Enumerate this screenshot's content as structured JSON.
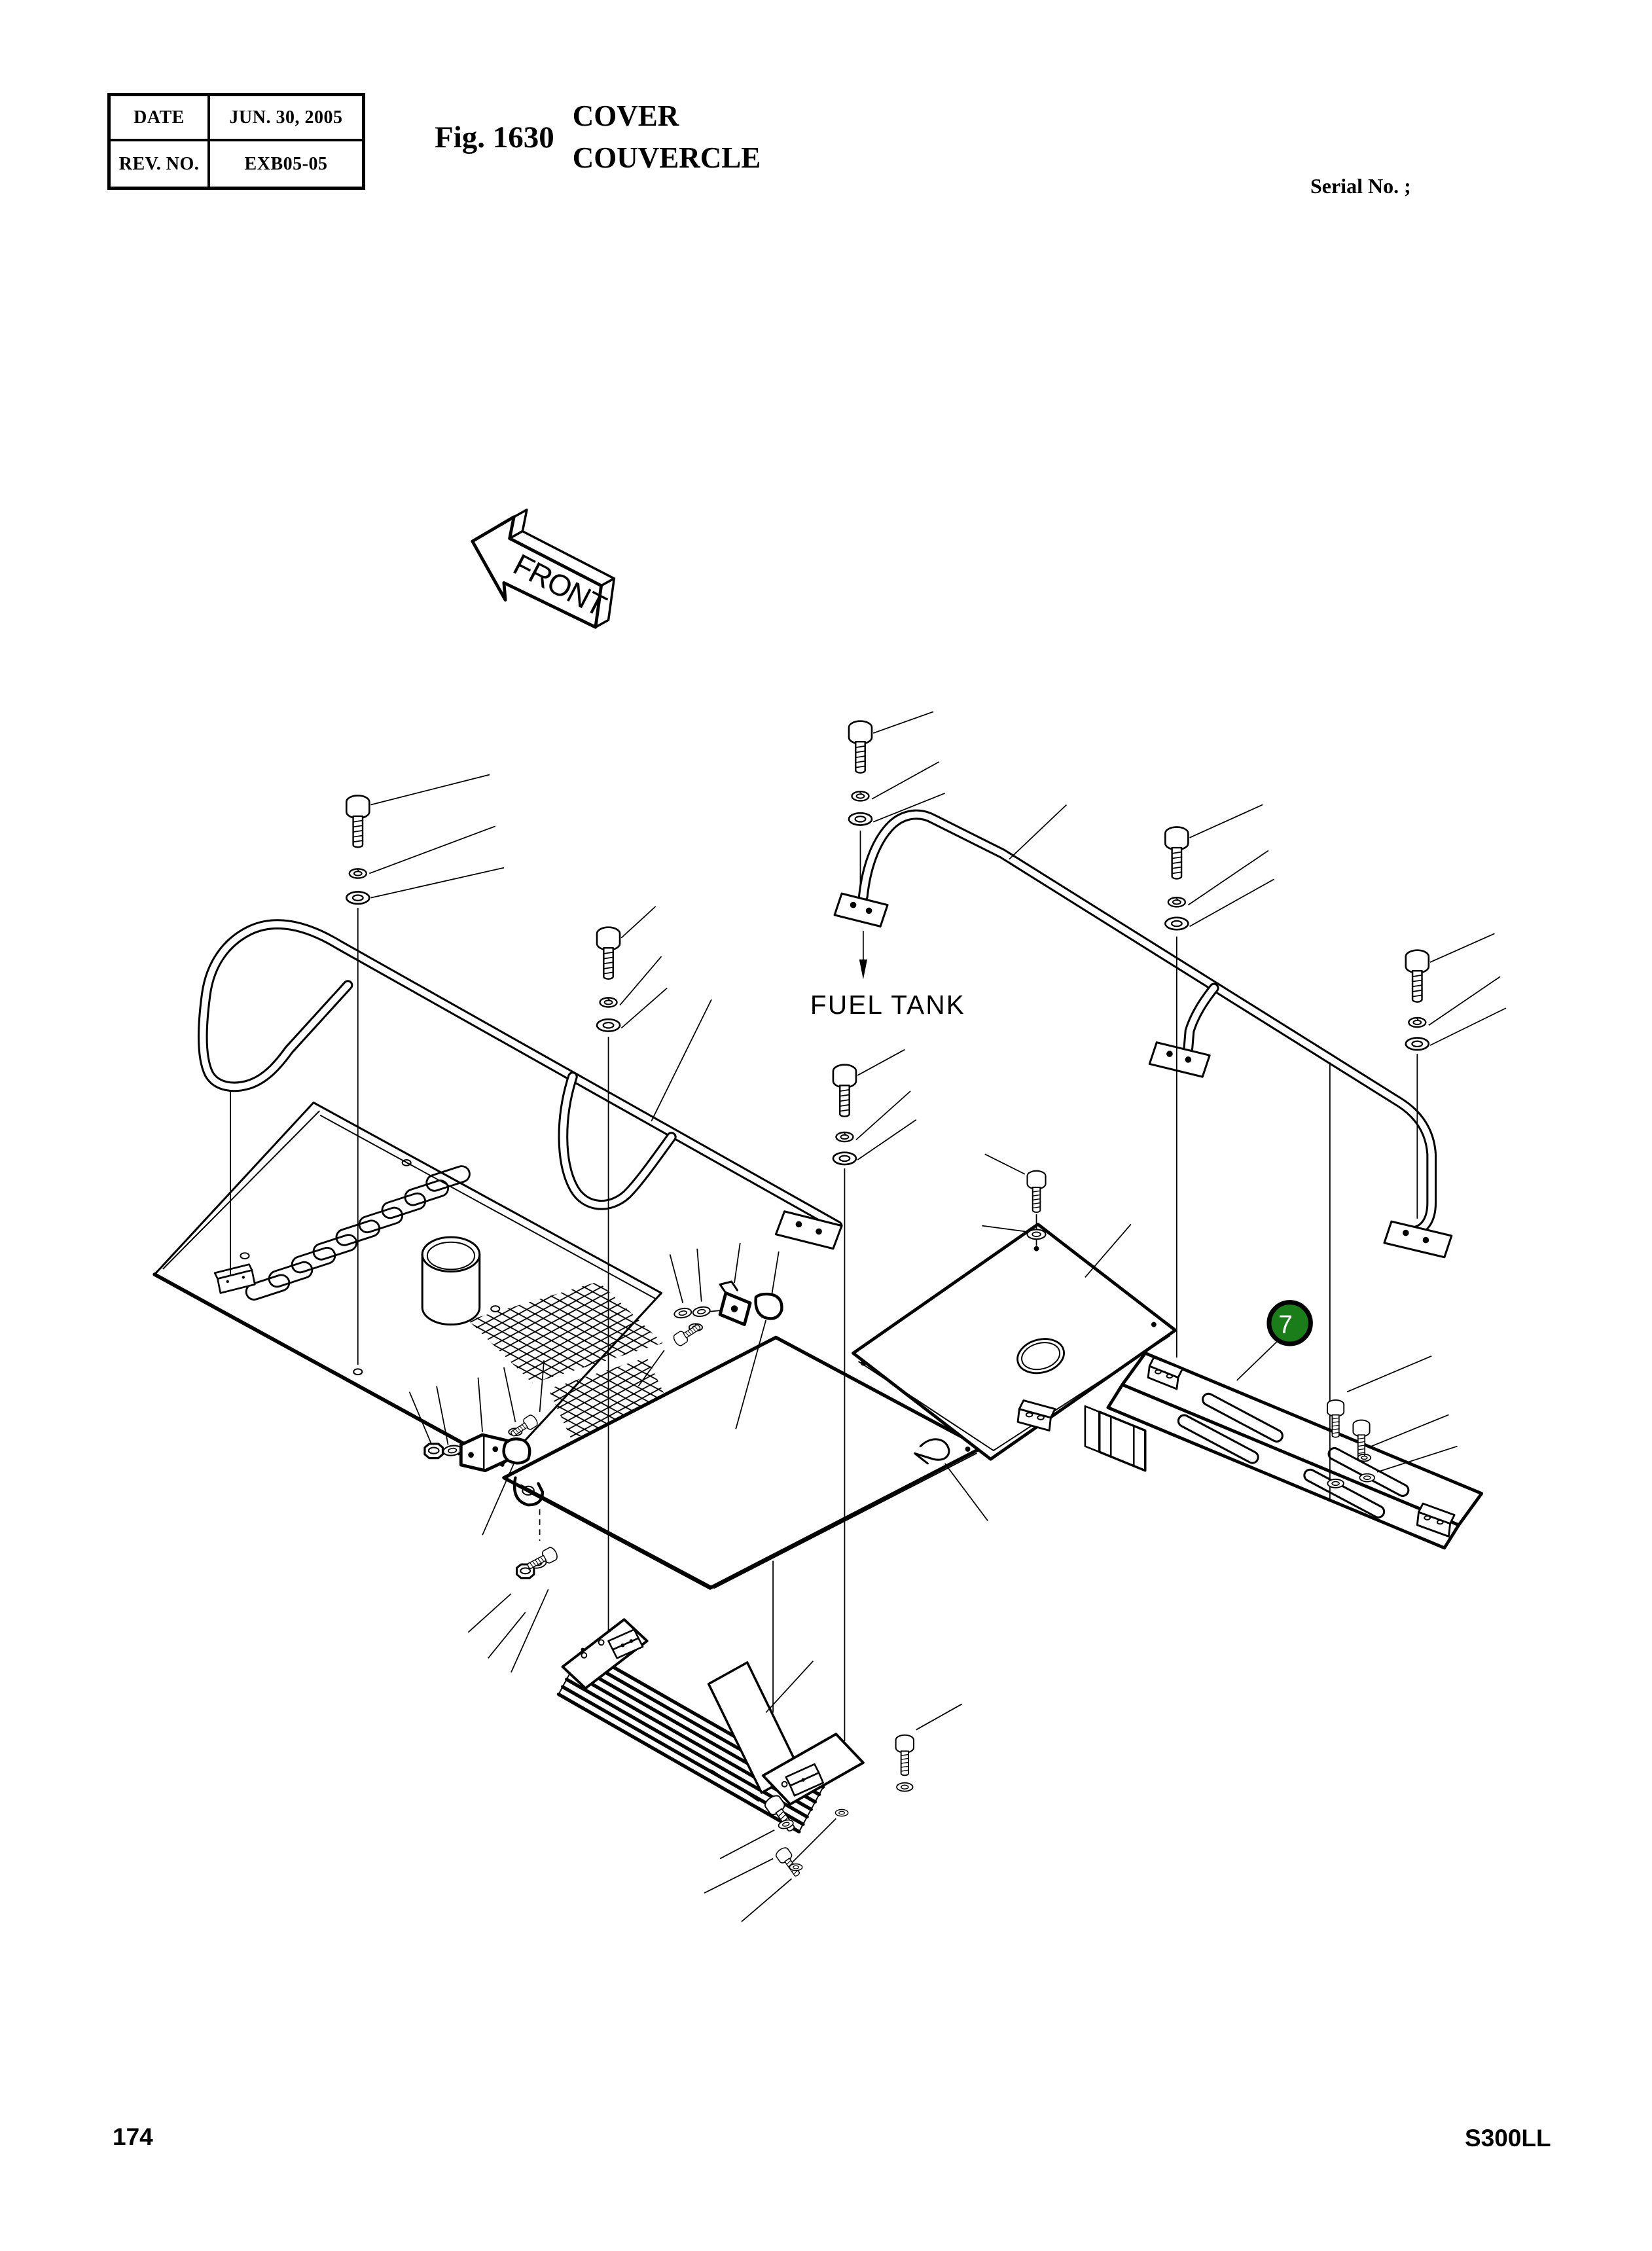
{
  "header": {
    "revision_table": {
      "rows": [
        {
          "label": "DATE",
          "value": "JUN. 30, 2005"
        },
        {
          "label": "REV. NO.",
          "value": "EXB05-05"
        }
      ]
    },
    "figure_label": "Fig. 1630",
    "title_primary": "COVER",
    "title_secondary": "COUVERCLE",
    "serial_text": "Serial No. ;"
  },
  "diagram": {
    "front_label": "FRONT",
    "fuel_tank_label": "FUEL TANK",
    "callout": {
      "number": "7",
      "fill_color": "#1a7d1a"
    }
  },
  "footer": {
    "page_number": "174",
    "model_code": "S300LL"
  }
}
